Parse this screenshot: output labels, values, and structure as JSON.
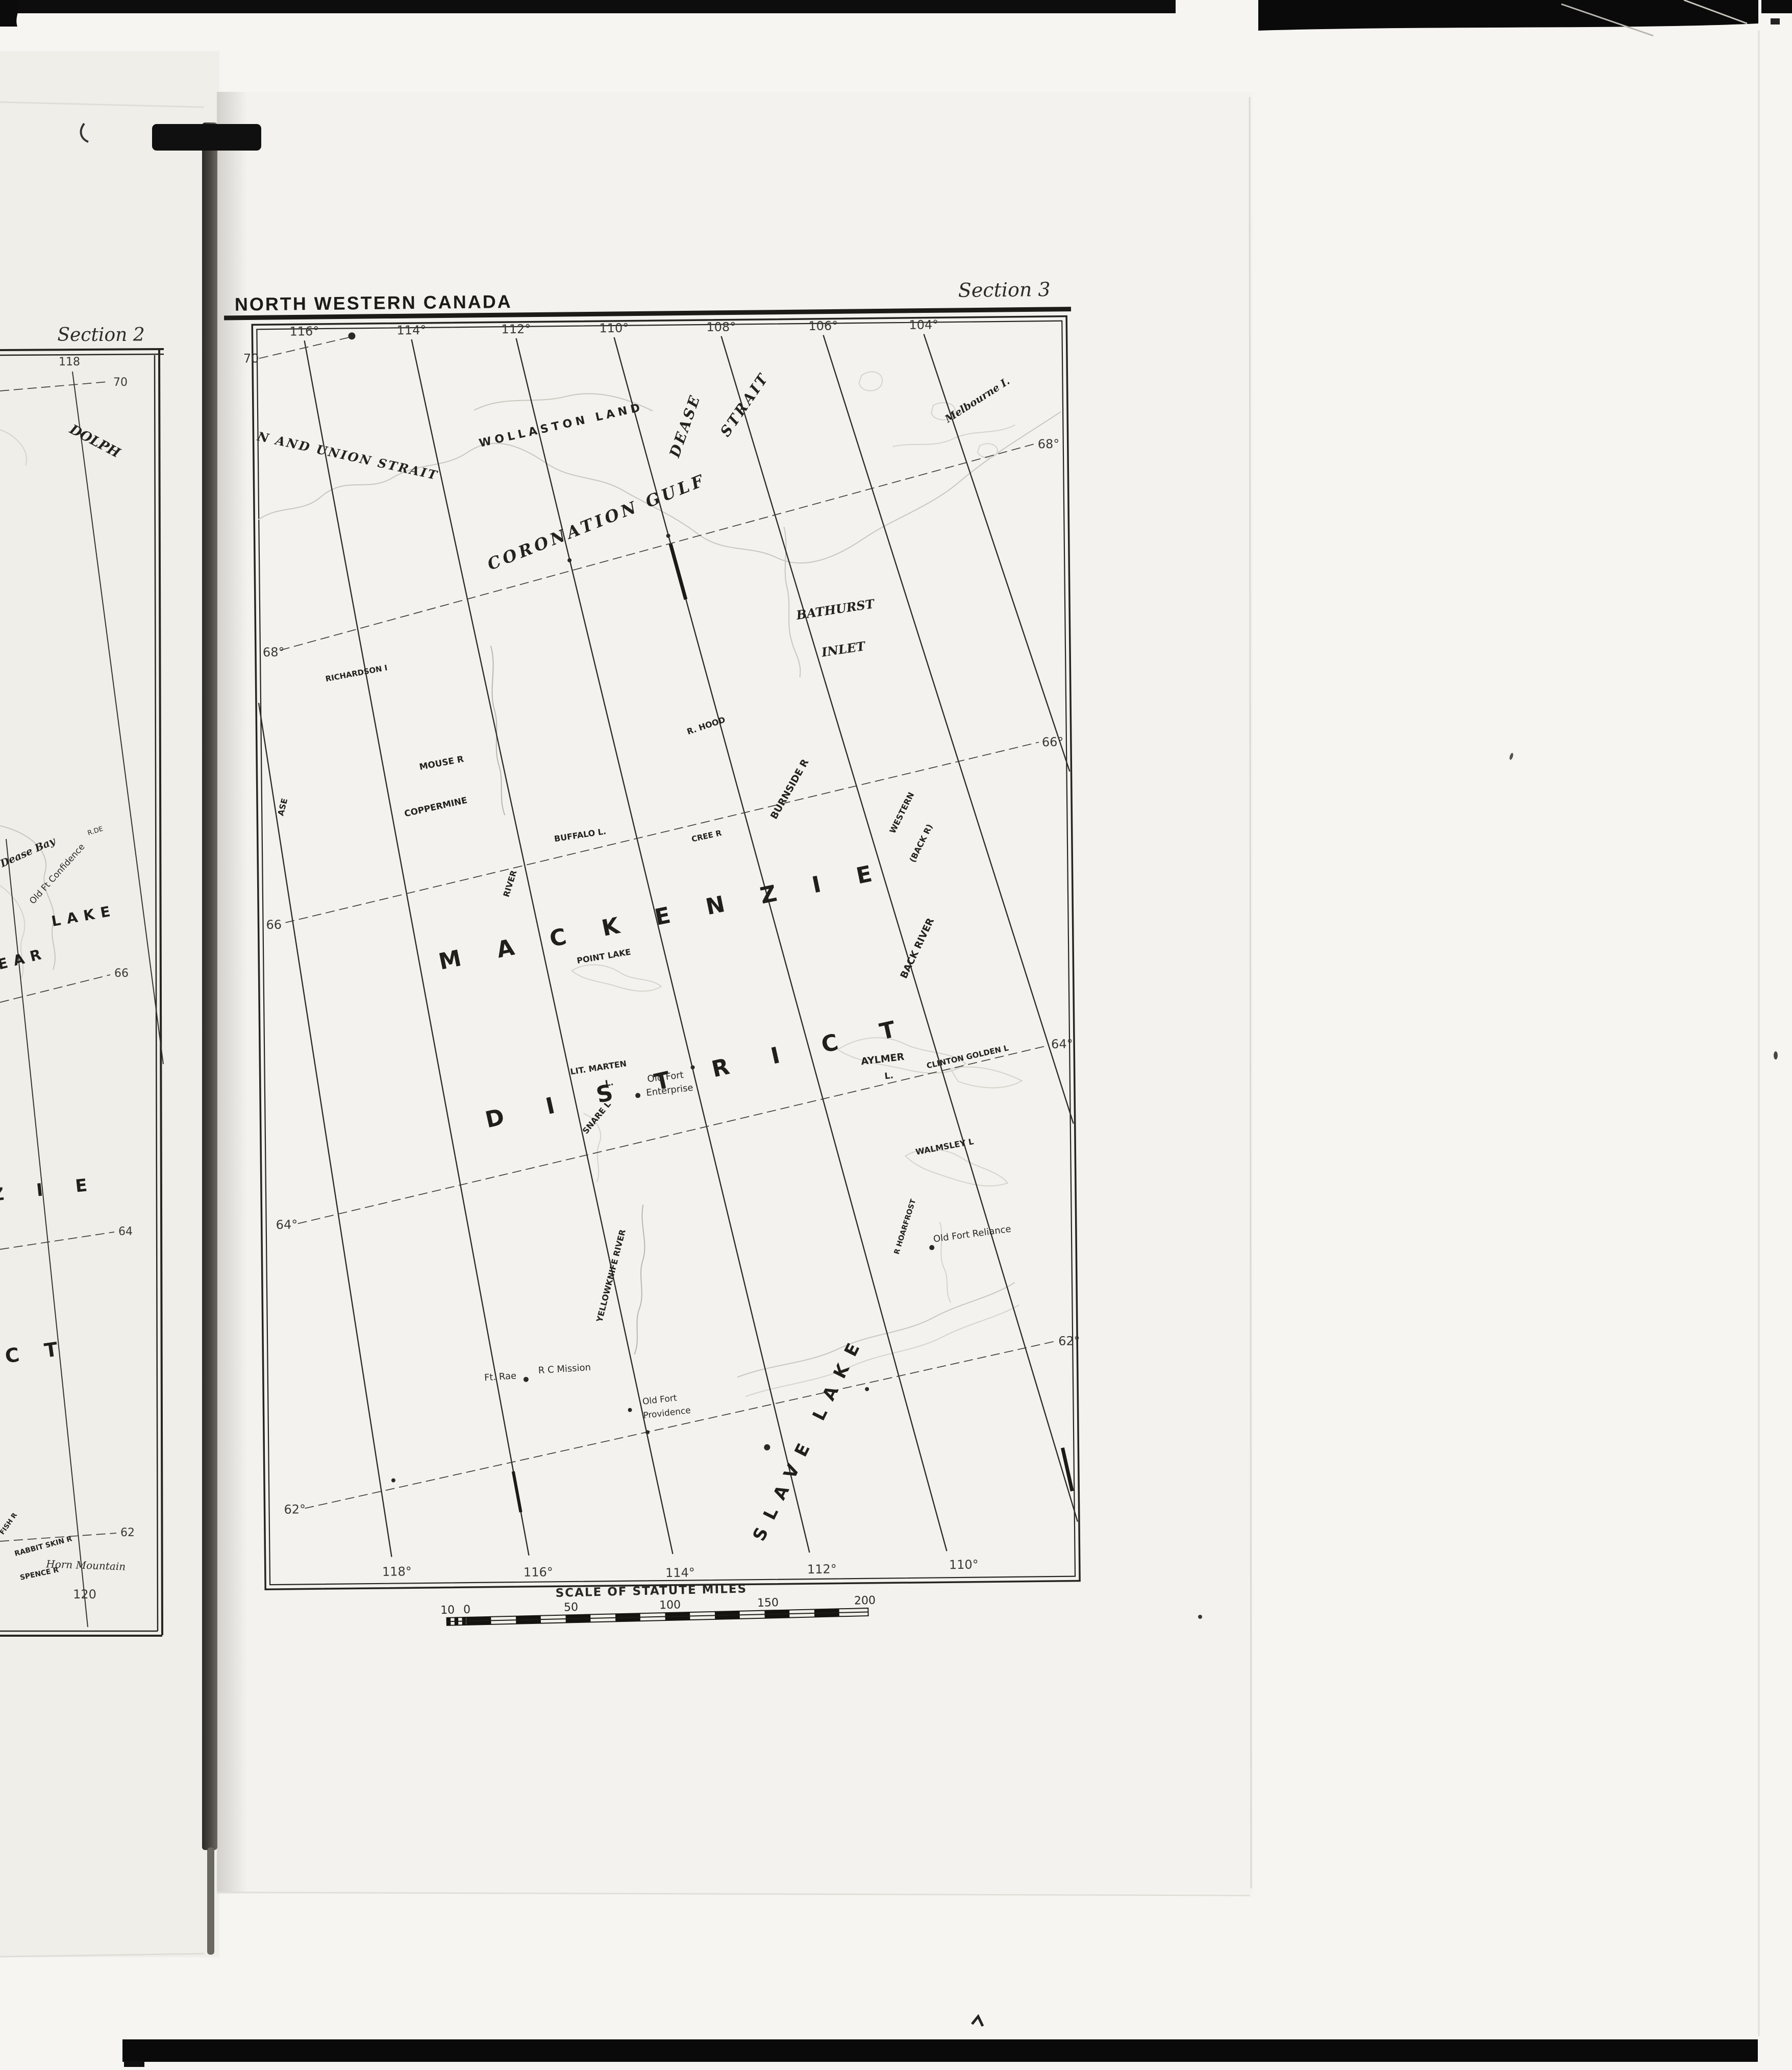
{
  "colors": {
    "ink": "#24221f",
    "paper_right": "#f4f2ee",
    "paper_left": "#f0eee9",
    "scan_black": "#0b0b0b",
    "coastline": "#c9c6bf"
  },
  "main_map": {
    "header": "NORTH WESTERN CANADA",
    "section_label": "Section 3",
    "top_meridians": [
      "116°",
      "114°",
      "112°",
      "110°",
      "108°",
      "106°",
      "104°"
    ],
    "bottom_meridians": [
      "118°",
      "116°",
      "114°",
      "112°",
      "110°"
    ],
    "lat_labels": {
      "l70": "70",
      "l68_left": "68°",
      "l68_right": "68°",
      "l66_left": "66",
      "l66_right": "66°",
      "l64_left": "64°",
      "l64_right": "64°",
      "l62_left": "62°",
      "l62_right": "62°"
    },
    "features": {
      "union_strait": "N AND UNION STRAIT",
      "wollaston_land": "WOLLASTON LAND",
      "dease": "DEASE",
      "strait": "STRAIT",
      "melbourne_i": "Melbourne I.",
      "coronation_gulf": "CORONATION GULF",
      "bathurst": "BATHURST",
      "inlet": "INLET",
      "richardson_i": "RICHARDSON I",
      "mouse_r": "MOUSE R",
      "coppermine": "COPPERMINE",
      "river": "RIVER",
      "ase": "ASE",
      "r_hood": "R. HOOD",
      "burnside_r": "BURNSIDE R",
      "western": "WESTERN",
      "back_r_paren": "(BACK R)",
      "buffalo_l": "BUFFALO L.",
      "cree_r": "CREE R",
      "mackenzie": "MACKENZIE",
      "point_lake": "POINT LAKE",
      "back_river": "BACK RIVER",
      "district": "DISTRICT",
      "lit_marten": "LIT. MARTEN",
      "lit_marten_l": "L.",
      "snare_l": "SNARE L",
      "old_fort_enterprise_1": "Old Fort",
      "old_fort_enterprise_2": "Enterprise",
      "aylmer": "AYLMER",
      "aylmer_l": "L.",
      "clinton_golden_l": "CLINTON GOLDEN L",
      "walmsley_l": "WALMSLEY L",
      "r_hoarfrost": "R HOARFROST",
      "old_fort_reliance": "Old Fort Reliance",
      "yellowknife_river": "YELLOWKNIFE RIVER",
      "ft_rae": "Ft. Rae",
      "rc_mission": "R C Mission",
      "old_fort_providence_1": "Old Fort",
      "old_fort_providence_2": "Providence",
      "slave_lake": "SLAVE LAKE"
    },
    "scale_bar": {
      "title": "SCALE OF STATUTE MILES",
      "ticks": [
        "10",
        "0",
        "50",
        "100",
        "150",
        "200"
      ]
    }
  },
  "left_map": {
    "section_label": "Section 2",
    "meridian_top": "118",
    "meridian_bottom": "120",
    "lat_labels": {
      "l70": "70",
      "l66": "66",
      "l64": "64",
      "l62": "62"
    },
    "features": {
      "dolph": "DOLPH",
      "dease_bay": "Dease Bay",
      "old_ft_confidence": "Old Ft Confidence",
      "r_de": "R.DE",
      "lake": "LAKE",
      "bear": "BEAR",
      "zie": "ZIE",
      "ct": "CT",
      "fish_r": "FISH R",
      "rabbit_skin_r": "RABBIT SKIN R",
      "spence_r": "SPENCE R",
      "horn_mountain": "Horn Mountain"
    }
  }
}
